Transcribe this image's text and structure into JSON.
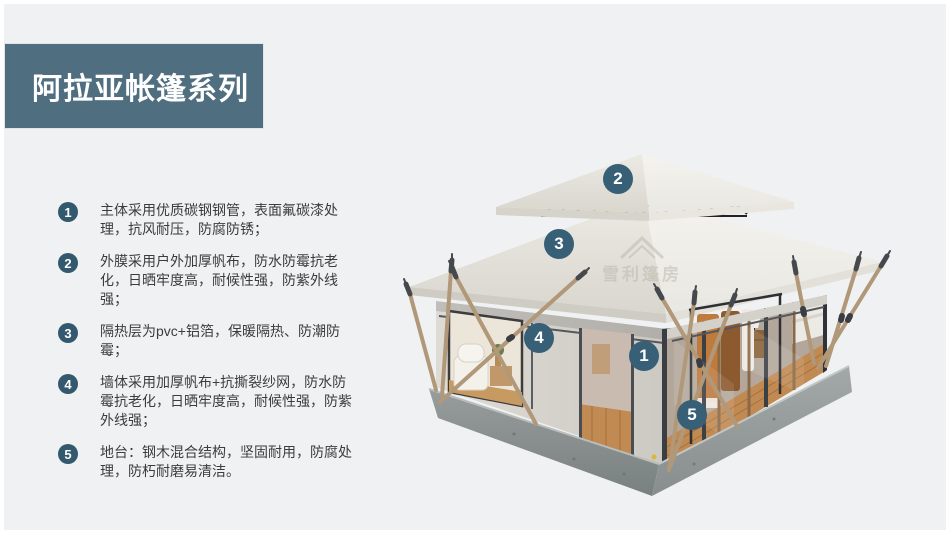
{
  "slide": {
    "title": "阿拉亚帐篷系列",
    "watermark": "雪利篷房"
  },
  "features": [
    {
      "num": "1",
      "text": "主体采用优质碳钢钢管，表面氟碳漆处理，抗风耐压，防腐防锈；"
    },
    {
      "num": "2",
      "text": "外膜采用户外加厚帆布，防水防霉抗老化，日晒牢度高，耐候性强，防紫外线强；"
    },
    {
      "num": "3",
      "text": "隔热层为pvc+铝箔，保暖隔热、防潮防霉；"
    },
    {
      "num": "4",
      "text": "墙体采用加厚帆布+抗撕裂纱网，防水防霉抗老化，日晒牢度高，耐候性强，防紫外线强；"
    },
    {
      "num": "5",
      "text": "地台：钢木混合结构，坚固耐用，防腐处理，防朽耐磨易清洁。"
    }
  ],
  "callouts": [
    {
      "num": "1"
    },
    {
      "num": "2"
    },
    {
      "num": "3"
    },
    {
      "num": "4"
    },
    {
      "num": "5"
    }
  ],
  "colors": {
    "background": "#f0f1f2",
    "banner": "#4f6e80",
    "list_badge": "#33596e",
    "photo_callout": "#375f76",
    "body_text": "#3c3c3c",
    "roof_canvas": "#ece9e3",
    "base_concrete": "#8f9695",
    "wood_pole": "#b09879",
    "deck_wood": "#c08a52"
  }
}
